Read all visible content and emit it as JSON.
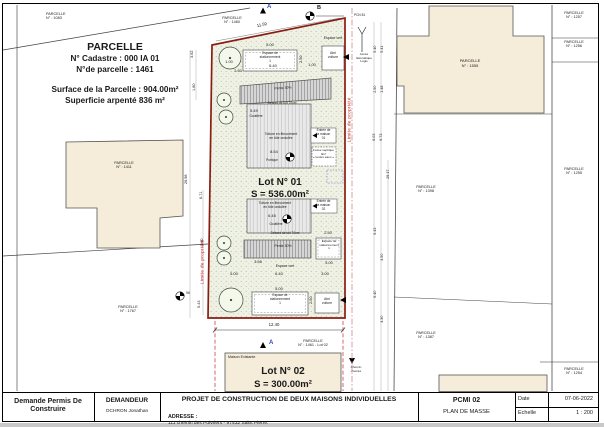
{
  "info": {
    "title": "PARCELLE",
    "cadastre": "N° Cadastre : 000 IA 01",
    "parcel": "N°de parcelle : 1461",
    "surface": "Surface de la Parcelle : 904.00m²",
    "surveyed": "Superficie arpenté 836 m²"
  },
  "neighbors": {
    "p1083": "PARCELLE\nN° : 1083",
    "p1460": "PARCELLE\nN° : 1460",
    "p1411": "PARCELLE\nN° : 1411",
    "p1767": "PARCELLE\nN° : 1767",
    "p1555": "PARCELLE\nN° : 1555",
    "p1257": "PARCELLE\nN° : 1257",
    "p1256": "PARCELLE\nN° : 1256",
    "p1255": "PARCELLE\nN° : 1255",
    "p1398": "PARCELLE\nN° : 1398",
    "p1387": "PARCELLE\nN° : 1387",
    "p1254": "PARCELLE\nN° : 1254"
  },
  "lots": {
    "lot1_title": "Lot N° 01",
    "lot1_area": "S = 536.00m²",
    "lot2_title": "Lot N° 02",
    "lot2_area": "S = 300.00m²",
    "lot2_existing": "Maison Existante",
    "lot2_parcel": "PARCELLE\nN° : 1461 - Lot 02"
  },
  "labels": {
    "limite": "Limite de propriété",
    "espace_vert": "Espace vert",
    "parking": "Espace de\nstationnement\n1",
    "abri": "Abri voiture",
    "pente": "Pente 30%",
    "debord": "Débord de toit 70cm",
    "gouttiere": "Gouttière",
    "toiture": "Toiture en fibrociment\nen tôle ondulée",
    "portique": "Portique",
    "entree1": "Entrée de\nla maison\n01",
    "entree2": "Entrée de\nla maison\n02",
    "fosse": "Fosse septique\n3m³\n« toutes eaux »",
    "a": "A",
    "b": "B",
    "pcn": "PCN 81",
    "acces": "Accès\ntélématique\nLogis",
    "chemin": "Chemin\nd'accès",
    "rep96": "96"
  },
  "dims": {
    "d1159": "11.59",
    "d500": "5.00",
    "d640": "6.40",
    "d100": "1.00",
    "d260": "2.60",
    "d250": "2.50",
    "d549": "5.49",
    "d854": "8.54",
    "d645": "6.45",
    "d356": "3.56",
    "d300": "3.00",
    "d1240": "12.40",
    "d362": "3.62",
    "d180": "1.80",
    "d2698": "26.98",
    "d671": "6.71",
    "d160": "1.60",
    "d543": "5.43",
    "d540": "5.40",
    "d541": "5.41",
    "d148": "1.48",
    "d603": "6.03",
    "d673": "6.73",
    "d2917": "29.17",
    "d643": "6.43",
    "d450": "4.50",
    "d430": "4.30"
  },
  "title_block": {
    "permit": "Demande Permis De Construire",
    "demandeur_label": "DEMANDEUR",
    "demandeur_name": "OCHRON Jonathan",
    "project_title": "PROJET DE CONSTRUCTION DE DEUX MAISONS INDIVIDUELLES",
    "address_label": "ADRESSE :",
    "address_value": "111 chemin des  Poivriers - 97432  Saint Pierre.",
    "doc_code": "PCMI 02",
    "doc_name": "PLAN DE MASSE",
    "date_label": "Date",
    "date_value": "07-06-2022",
    "scale_label": "Echelle",
    "scale_value": "1 : 200"
  }
}
